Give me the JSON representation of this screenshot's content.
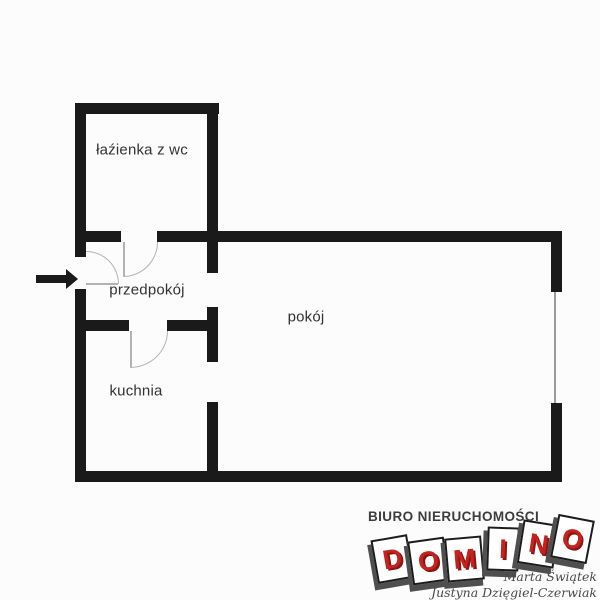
{
  "page": {
    "background": "#fcfcfc"
  },
  "floorplan": {
    "wall_color": "#1a1a1a",
    "door_arc_color": "#b3b3b3",
    "window_color": "#9a9a9a",
    "entrance_arrow_direction": "right",
    "rooms": [
      {
        "id": "bathroom",
        "label": "łaźienka z wc"
      },
      {
        "id": "hallway",
        "label": "przedpokój"
      },
      {
        "id": "kitchen",
        "label": "kuchnia"
      },
      {
        "id": "room",
        "label": "pokój"
      }
    ]
  },
  "branding": {
    "agency_type": "BIURO NIERUCHOMOŚCI",
    "logo_letters": [
      "D",
      "O",
      "M",
      "I",
      "N",
      "O"
    ],
    "logo_letter_color": "#c2231f",
    "tile_color": "#ffffff",
    "agents": [
      "Marta Świątek",
      "Justyna Dzięgiel-Czerwiak"
    ]
  }
}
